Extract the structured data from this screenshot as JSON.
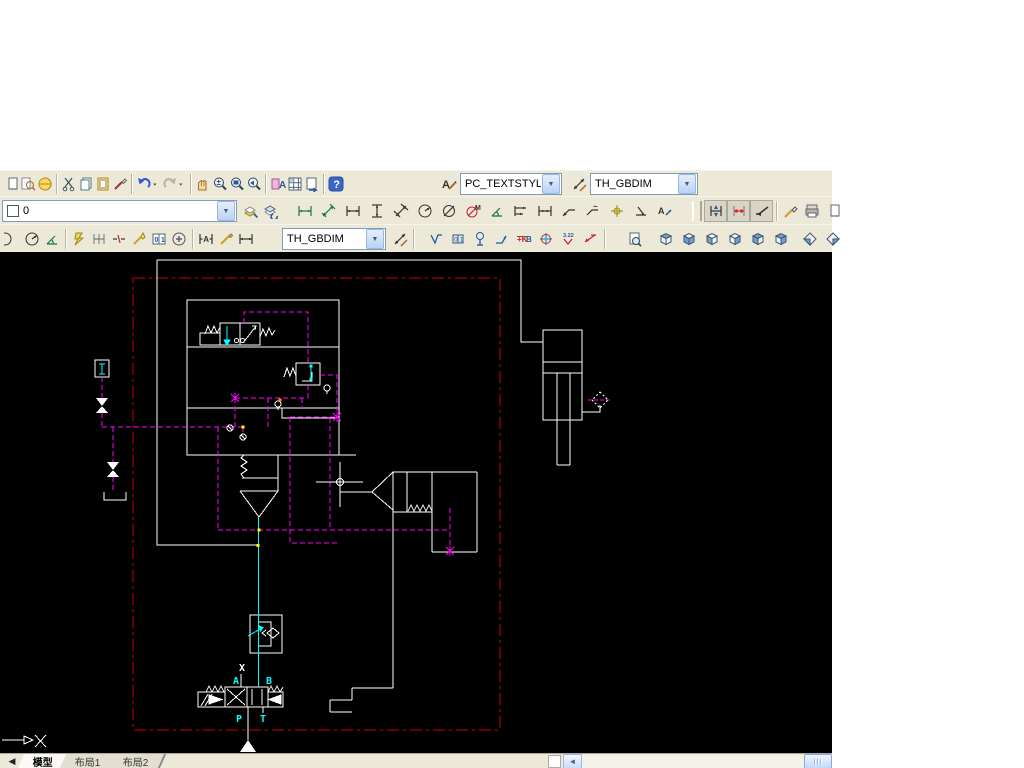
{
  "app": {
    "toolbar_bg": "#ece9d8",
    "canvas_bg": "#000000"
  },
  "colors": {
    "schematic_white": "#ffffff",
    "pilot_magenta": "#ff00ff",
    "pressure_cyan": "#00ffff",
    "plot_border_red": "#c80000",
    "junction_yellow": "#ffff00",
    "junction_orange": "#ff9000"
  },
  "combos": {
    "text_style": {
      "value": "PC_TEXTSTYLE"
    },
    "dim_style_top": {
      "value": "TH_GBDIM"
    },
    "layer": {
      "value": "0"
    },
    "dim_style_row3": {
      "value": "TH_GBDIM"
    }
  },
  "toolbars": {
    "row1_left": [
      {
        "icon": "new-drawing-clipped-icon",
        "form": "pagehalf"
      },
      {
        "icon": "find-icon",
        "form": "find"
      },
      {
        "icon": "publish-icon",
        "form": "globe"
      },
      {
        "sep": true
      },
      {
        "icon": "cut-icon",
        "form": "scissors"
      },
      {
        "icon": "copy-icon",
        "form": "pages"
      },
      {
        "icon": "paste-icon",
        "form": "clipboard"
      },
      {
        "icon": "match-properties-icon",
        "form": "brush"
      },
      {
        "sep": true
      },
      {
        "icon": "undo-icon",
        "form": "undo"
      },
      {
        "icon": "undo-dropdown-icon",
        "form": "dropdn",
        "w": 9
      },
      {
        "icon": "redo-icon",
        "form": "redo"
      },
      {
        "icon": "redo-dropdown-icon",
        "form": "dropdn",
        "w": 9
      },
      {
        "sep": true
      },
      {
        "icon": "pan-icon",
        "form": "hand"
      },
      {
        "icon": "zoom-realtime-icon",
        "form": "magpm"
      },
      {
        "icon": "zoom-window-icon",
        "form": "magwin"
      },
      {
        "icon": "zoom-previous-icon",
        "form": "magprev"
      },
      {
        "sep": true
      },
      {
        "icon": "properties-icon",
        "form": "propA"
      },
      {
        "icon": "designcenter-icon",
        "form": "grid"
      },
      {
        "icon": "sheet-set-manager-icon",
        "form": "pagearrow"
      },
      {
        "sep": true
      },
      {
        "icon": "help-icon",
        "form": "help"
      }
    ],
    "row1_right": [
      {
        "icon": "text-style-icon",
        "form": "apencil",
        "w": 22
      },
      {
        "combo": "text_style",
        "width": 100,
        "name": "text-style-combo"
      },
      {
        "gap": 6
      },
      {
        "icon": "dim-style-manager-icon",
        "form": "dimstyleic",
        "w": 22
      },
      {
        "combo": "dim_style_top",
        "width": 106,
        "name": "dim-style-combo"
      }
    ],
    "row2_left": [
      {
        "combo": "layer",
        "width": 233,
        "swatch": true,
        "name": "layer-combo"
      },
      {
        "gap": 4
      },
      {
        "icon": "make-object-layer-current-icon",
        "form": "layers"
      },
      {
        "icon": "layer-previous-icon",
        "form": "layers2"
      }
    ],
    "row2_dims": [
      {
        "icon": "dim-linear-icon",
        "form": "dimh",
        "c": "#1a7a3a"
      },
      {
        "icon": "dim-aligned-icon",
        "form": "dimalign",
        "c": "#1a7a3a"
      },
      {
        "icon": "dim-horizontal-icon",
        "form": "dimh",
        "c": "#333333"
      },
      {
        "icon": "dim-vertical-icon",
        "form": "dimv",
        "c": "#333333"
      },
      {
        "icon": "dim-rotated-icon",
        "form": "dimrot"
      },
      {
        "icon": "dim-radius-icon",
        "form": "dimrad"
      },
      {
        "icon": "dim-diameter-icon",
        "form": "dimdia"
      },
      {
        "icon": "dim-angular-icon",
        "form": "dimangM"
      },
      {
        "icon": "dim-arc-length-icon",
        "form": "dimang2"
      },
      {
        "icon": "dim-baseline-icon",
        "form": "dimbase"
      },
      {
        "icon": "dim-continue-icon",
        "form": "dimcont"
      },
      {
        "icon": "quick-leader-icon",
        "form": "dimlead"
      },
      {
        "icon": "tolerance-icon",
        "form": "dimlead2"
      },
      {
        "icon": "center-mark-icon",
        "form": "centerdot"
      },
      {
        "icon": "dim-oblique-icon",
        "form": "dimob"
      },
      {
        "icon": "dim-edit-icon",
        "form": "dimedit"
      }
    ],
    "row2_right": [
      {
        "handle": true
      },
      {
        "icon": "dim-update-icon",
        "form": "dimupd",
        "bg": true
      },
      {
        "icon": "dim-style-compare-icon",
        "form": "dimcmp",
        "bg": true
      },
      {
        "icon": "leader-icon",
        "form": "arrowl",
        "bg": true
      },
      {
        "sep": true
      },
      {
        "icon": "sketch-icon",
        "form": "pencildiam"
      },
      {
        "icon": "plot-icon",
        "form": "printer"
      },
      {
        "icon": "clipped-right-icon",
        "form": "pagehalf"
      }
    ],
    "row3": [
      {
        "icon": "circle-clipped-icon",
        "form": "halfcirc"
      },
      {
        "icon": "jogged-radius-icon",
        "form": "dimrad"
      },
      {
        "icon": "angular-dim-icon",
        "form": "dimang2"
      },
      {
        "sep": true
      },
      {
        "icon": "quick-dim-icon",
        "form": "qdim"
      },
      {
        "icon": "dim-space-icon",
        "form": "qdim2"
      },
      {
        "icon": "dim-break-icon",
        "form": "qdim3"
      },
      {
        "icon": "inspection-dim-icon",
        "form": "wizard"
      },
      {
        "icon": "window-01-icon",
        "form": "win01"
      },
      {
        "icon": "plus-circle-icon",
        "form": "pluscirc"
      },
      {
        "sep": true
      },
      {
        "icon": "dim-text-edit-icon",
        "form": "dimtextA"
      },
      {
        "icon": "dim-edit-pencil-icon",
        "form": "pencil"
      },
      {
        "icon": "dim-update-2-icon",
        "form": "dimh",
        "c": "#333333"
      },
      {
        "gap": 26
      },
      {
        "combo": "dim_style_row3",
        "width": 102,
        "name": "dim-style-combo-2"
      },
      {
        "gap": 4
      },
      {
        "icon": "dim-style-apply-icon",
        "form": "dimstyleic"
      },
      {
        "sep": true
      },
      {
        "gap": 8
      },
      {
        "icon": "surface-finish-icon",
        "form": "surface",
        "w": 22
      },
      {
        "icon": "datum-target-icon",
        "form": "datum",
        "w": 22
      },
      {
        "icon": "stamp-symbol-icon",
        "form": "stamp",
        "w": 22
      },
      {
        "icon": "bend-leader-icon",
        "form": "bendarrow",
        "w": 22
      },
      {
        "icon": "kb-symbol-icon",
        "form": "kb",
        "w": 22
      },
      {
        "icon": "target-symbol-icon",
        "form": "targetsym",
        "w": 22
      },
      {
        "icon": "weld-symbol-icon",
        "form": "weld322",
        "w": 22
      },
      {
        "icon": "red-leader-icon",
        "form": "redarrow",
        "w": 22
      },
      {
        "sep": true
      },
      {
        "gap": 16
      },
      {
        "icon": "preview-icon",
        "form": "pagemag",
        "w": 22
      },
      {
        "gap": 8
      },
      {
        "icon": "view-top-icon",
        "form": "cube1",
        "w": 23
      },
      {
        "icon": "view-bottom-icon",
        "form": "cube2",
        "w": 23
      },
      {
        "icon": "view-left-icon",
        "form": "cube3",
        "w": 23
      },
      {
        "icon": "view-right-icon",
        "form": "cube4",
        "w": 23
      },
      {
        "icon": "view-front-icon",
        "form": "cube5",
        "w": 23
      },
      {
        "icon": "view-back-icon",
        "form": "cube6",
        "w": 23
      },
      {
        "gap": 6
      },
      {
        "icon": "view-sw-iso-icon",
        "form": "cubeiso1",
        "w": 23
      },
      {
        "icon": "view-se-iso-icon",
        "form": "cubeiso2",
        "w": 23
      }
    ]
  },
  "canvas_labels": {
    "port_a": "A",
    "port_b": "B",
    "port_p": "P",
    "port_t": "T",
    "blocked_port": "X"
  },
  "tabs": {
    "nav": "◀",
    "items": [
      {
        "label": "模型",
        "active": true
      },
      {
        "label": "布局1",
        "active": false
      },
      {
        "label": "布局2",
        "active": false
      }
    ]
  },
  "scrollbar": {
    "left_arrow": "◄"
  }
}
